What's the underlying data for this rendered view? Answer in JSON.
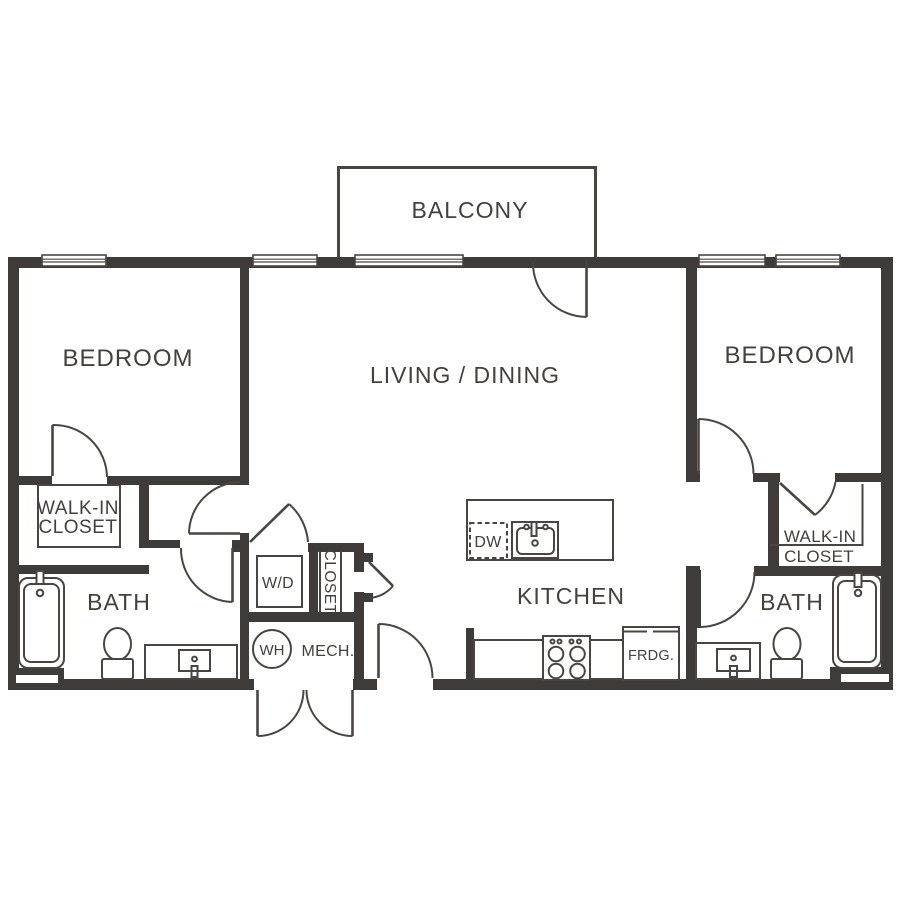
{
  "colors": {
    "wall": "#3f3b38",
    "line": "#4a4541",
    "text": "#45403c",
    "background": "#ffffff"
  },
  "labels": {
    "balcony": "BALCONY",
    "living_dining": "LIVING / DINING",
    "bedroom_left": "BEDROOM",
    "bedroom_right": "BEDROOM",
    "bath_left": "BATH",
    "bath_right": "BATH",
    "kitchen": "KITCHEN",
    "walk_in_closet_left_line1": "WALK-IN",
    "walk_in_closet_left_line2": "CLOSET",
    "walk_in_closet_right_line1": "WALK-IN",
    "walk_in_closet_right_line2": "CLOSET",
    "washer_dryer": "W/D",
    "hall_closet": "CLOSET",
    "water_heater": "WH",
    "mechanical": "MECH.",
    "dishwasher": "DW",
    "fridge": "FRDG."
  }
}
